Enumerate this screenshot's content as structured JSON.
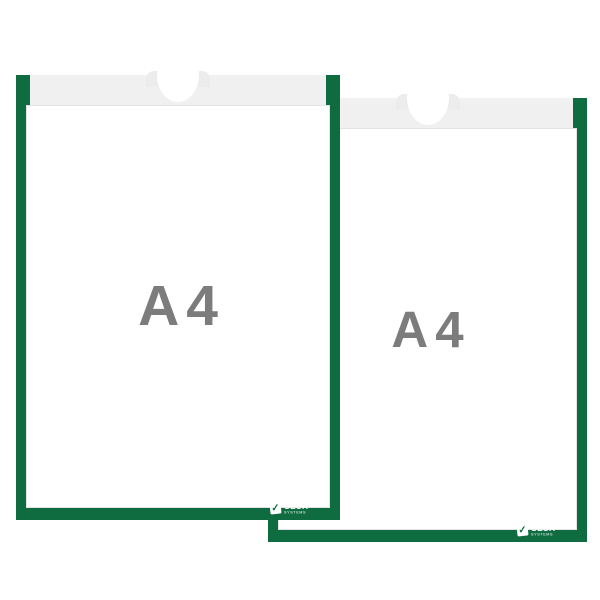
{
  "product": {
    "description": "Two overlapping A4 document display pockets with green frames",
    "colors": {
      "frame_green": "#0e6c40",
      "band_gray": "#ececec",
      "paper_white": "#ffffff",
      "label_gray": "#7c7c7c"
    },
    "frames": [
      {
        "id": "front-left",
        "size_label": "A4",
        "logo": {
          "brand": "SESA",
          "sub": "SYSTEMS",
          "check": "✓"
        }
      },
      {
        "id": "back-right",
        "size_label": "A4",
        "logo": {
          "brand": "SESA",
          "sub": "SYSTEMS",
          "check": "✓"
        }
      }
    ]
  }
}
